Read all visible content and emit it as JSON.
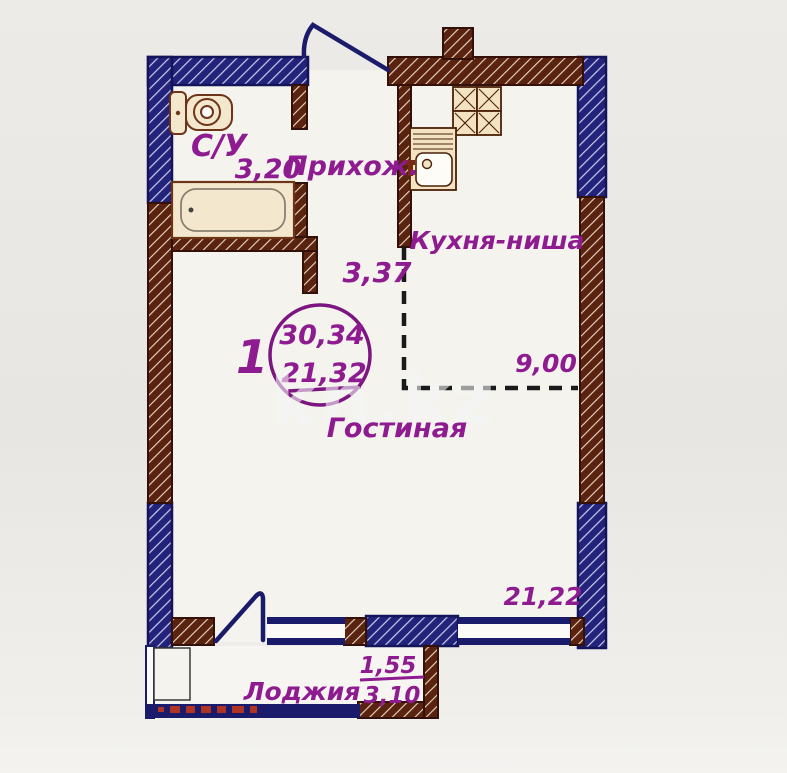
{
  "watermark_text": "kn.kz",
  "stamp": {
    "apartment_number": "1",
    "total_area": "30,34",
    "second_area": "21,32"
  },
  "rooms": {
    "bathroom": {
      "label": "С/У",
      "area": "3,20"
    },
    "hallway": {
      "label": "Прихож.",
      "area": "3,37"
    },
    "kitchen_niche": {
      "label": "Кухня-ниша",
      "area": "9,00"
    },
    "living_room": {
      "label": "Гостиная",
      "area": "21,22"
    },
    "loggia": {
      "label": "Лоджия",
      "area_with_coefficient": "1,55",
      "area_full": "3,10"
    }
  },
  "colors": {
    "wall_concrete_blue": "#23237b",
    "wall_brick_brown": "#5a2310",
    "outline_navy": "#1b1b6b",
    "label_purple": "#8e1b90",
    "fixture_fill": "#f3e6c8",
    "background": "#e9e7e3",
    "watermark": "#f5f5f5"
  }
}
